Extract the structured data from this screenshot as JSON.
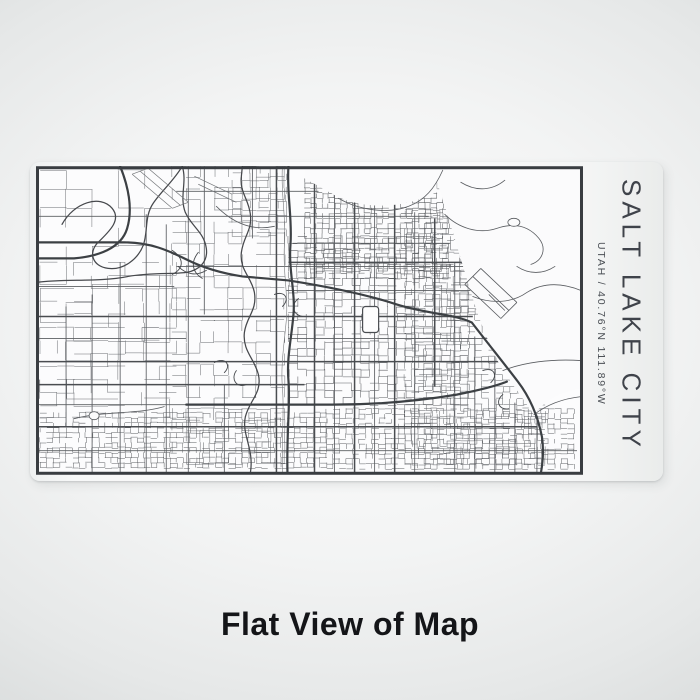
{
  "product": {
    "city_display": "SALT LAKE CITY",
    "coordinates": "UTAH / 40.76°N 111.89°W",
    "caption": "Flat View of Map"
  },
  "colors": {
    "ink": "#3f434a",
    "ink2": "#4b4f55",
    "caption_ink": "#141518",
    "backdrop_inner": "#fdfdfd",
    "backdrop_outer": "#c7caca",
    "wrap_fill": "#f8f9f9",
    "map_bg": "#fcfcfd",
    "frame_stroke": "#393d41"
  },
  "map": {
    "viewbox": [
      0,
      0,
      546,
      308
    ],
    "bg": "#fcfcfd",
    "cover_fill": "#fbfbfc",
    "frame": {
      "inset": 1.5,
      "width": 3,
      "stroke": "#393d41"
    },
    "districts": [
      {
        "x": 4,
        "y": 4,
        "w": 132,
        "h": 248,
        "cw": 26,
        "ch": 19,
        "skip": 0.55,
        "c": "#63666a",
        "wd": 0.5,
        "seed": 11
      },
      {
        "x": 4,
        "y": 96,
        "w": 140,
        "h": 150,
        "cw": 17,
        "ch": 13,
        "skip": 0.5,
        "c": "#63666a",
        "wd": 0.5,
        "seed": 12
      },
      {
        "x": 136,
        "y": 0,
        "w": 116,
        "h": 302,
        "cw": 14,
        "ch": 11,
        "skip": 0.45,
        "c": "#606367",
        "wd": 0.5,
        "seed": 22
      },
      {
        "x": 196,
        "y": 0,
        "w": 60,
        "h": 70,
        "cw": 9,
        "ch": 7,
        "skip": 0.4,
        "c": "#606367",
        "wd": 0.5,
        "seed": 23
      },
      {
        "x": 268,
        "y": 12,
        "w": 146,
        "h": 100,
        "cw": 6,
        "ch": 5,
        "skip": 0.24,
        "c": "#54575b",
        "wd": 0.55,
        "seed": 33
      },
      {
        "x": 252,
        "y": 70,
        "w": 180,
        "h": 172,
        "cw": 9,
        "ch": 7,
        "skip": 0.3,
        "c": "#56595d",
        "wd": 0.55,
        "seed": 44
      },
      {
        "x": 368,
        "y": 44,
        "w": 96,
        "h": 104,
        "cw": 7,
        "ch": 6,
        "skip": 0.34,
        "c": "#5a5d61",
        "wd": 0.5,
        "seed": 55
      },
      {
        "x": 368,
        "y": 142,
        "w": 140,
        "h": 158,
        "cw": 7,
        "ch": 6,
        "skip": 0.32,
        "c": "#5a5d61",
        "wd": 0.5,
        "seed": 56
      },
      {
        "x": 4,
        "y": 246,
        "w": 290,
        "h": 56,
        "cw": 6.5,
        "ch": 5,
        "skip": 0.3,
        "c": "#56595d",
        "wd": 0.5,
        "seed": 66
      },
      {
        "x": 290,
        "y": 242,
        "w": 248,
        "h": 62,
        "cw": 6.5,
        "ch": 5,
        "skip": 0.34,
        "c": "#56595d",
        "wd": 0.5,
        "seed": 77
      }
    ],
    "covers": [
      "M394,0 H544 V222 C520,226 506,236 497,248 L466,204 C454,182 444,158 436,132 C428,106 418,72 410,46 C405,30 400,14 394,0 Z",
      "M268,0 H400 V26 C368,42 330,44 300,30 L268,12 Z"
    ],
    "layers": {
      "majors": {
        "c": "#5b5e62",
        "w": 0.85,
        "d": [
          "M30,140 V260",
          "M56,128 V306",
          "M84,96 V306",
          "M110,48 V306",
          "M130,58 V306",
          "M152,0 V306",
          "M168,0 V148",
          "M188,218 V306",
          "M216,0 V72",
          "M298,14 V306",
          "M338,30 V306",
          "M378,46 V306",
          "M418,96 V306",
          "M438,170 V306",
          "M458,190 V306",
          "M478,236 V306",
          "M500,248 V306",
          "M140,25 H282",
          "M0,50 H392",
          "M256,77 H414",
          "M140,100 H430",
          "M250,124 H434",
          "M252,172 H452",
          "M0,238 H150",
          "M0,284 H540",
          "M0,120 H138",
          "M0,172 H150"
        ]
      },
      "darkMajors": {
        "c": "#4a4d51",
        "w": 1.5,
        "d": [
          "M240,0 V306",
          "M278,16 V306",
          "M318,24 V306",
          "M358,34 V306",
          "M398,52 V220",
          "M252,96 H430",
          "M0,150 H436",
          "M0,195 H464",
          "M0,218 H268",
          "M0,260 H500"
        ]
      },
      "diagonals": {
        "c": "#56595d",
        "w": 0.8,
        "d": [
          "M428,118 L464,152",
          "M436,110 L472,144",
          "M444,102 L480,136",
          "M428,118 L444,102",
          "M464,152 L480,136",
          "M452,128 L468,144"
        ]
      },
      "curvies": {
        "c": "#595c60",
        "w": 0.8,
        "d": [
          "M302,32 C322,44 352,48 372,40 C388,34 398,22 406,4",
          "M408,48 C422,62 442,68 460,62 C478,56 492,60 502,72 C510,82 506,94 494,98",
          "M436,130 C456,138 476,136 490,126 C506,116 524,116 544,124",
          "M466,204 C486,196 514,192 544,194",
          "M497,248 C510,238 526,232 544,230",
          "M424,16 C440,26 456,24 468,14",
          "M480,100 C492,108 506,108 518,100",
          "M38,252 C70,244 100,248 128,240",
          "M180,40 C200,60 220,64 238,60"
        ]
      },
      "ramps": {
        "c": "#46494d",
        "w": 0.9,
        "d": [
          "M136,84 C148,92 148,102 136,108",
          "M162,86 C154,96 156,106 166,112",
          "M238,128 C248,124 254,132 246,140",
          "M262,132 C254,138 256,148 266,150",
          "M178,196 C188,190 196,198 188,206",
          "M200,204 C194,212 200,222 210,218",
          "M446,204 C456,200 462,208 454,216",
          "M466,228 C458,234 462,244 472,242",
          "M142,100 C150,108 160,110 170,104"
        ]
      },
      "railroad": {
        "c": "#77797c",
        "w": 0.6,
        "d": [
          "M246,0 C244,26 250,52 248,78 C246,104 252,128 250,152 C248,176 244,198 246,222 C248,244 245,268 246,306"
        ]
      },
      "highways": {
        "c": "#3c4044",
        "w": 2.2,
        "d": [
          "M0,76 H88 C114,76 132,84 150,93 C168,102 186,107 206,110 L252,114",
          "M252,0 C250,26 256,52 254,78 C252,104 259,126 257,148 C255,172 250,192 252,214 C254,238 250,264 251,306",
          "M252,114 C290,120 330,128 360,138 C392,148 416,147 435,156",
          "M435,156 C452,178 468,198 481,215 C494,232 501,250 505,270 C507,284 506,295 504,306",
          "M84,0 C92,20 97,42 91,62 C85,82 62,90 38,92 L0,92",
          "M150,238 H296 C340,238 384,234 420,228 C440,224 458,220 470,215"
        ]
      },
      "water": {
        "c": "#46484c",
        "w": 1.25,
        "d": [
          "M26,58 C38,36 64,28 76,42 C86,54 72,66 62,76 C52,86 56,100 72,102 C88,104 102,92 107,79 C112,66 108,50 117,37 C125,25 138,14 146,0",
          "M146,0 C151,16 143,30 149,46 C155,60 168,66 170,82 C172,96 162,104 150,106",
          "M214,306 C218,282 205,268 209,250 C213,234 226,226 222,208 C218,192 206,184 208,166 C210,150 221,144 218,126 C215,110 203,104 205,86 C207,70 216,64 214,48 C212,32 203,26 205,10 L206,0",
          "M0,116 C30,112 62,116 92,110 C116,106 136,108 150,106"
        ]
      },
      "runways": {
        "c": "#737679",
        "w": 0.7,
        "d": [
          "M96,8 L136,42",
          "M104,5 L144,39",
          "M112,2 L152,36",
          "M96,8 L112,2",
          "M136,42 L152,36",
          "M158,10 L196,28",
          "M162,18 L200,36"
        ]
      }
    },
    "shapes": [
      {
        "type": "rect",
        "x": 326,
        "y": 140,
        "w": 16,
        "h": 26,
        "rx": 3,
        "stroke": "#4a4d51",
        "sw": 1.2,
        "fill": "#fdfdfd"
      },
      {
        "type": "ellipse",
        "cx": 477,
        "cy": 56,
        "rx": 6,
        "ry": 4,
        "stroke": "#595c60",
        "sw": 0.8,
        "fill": "#fbfbfc"
      },
      {
        "type": "ellipse",
        "cx": 58,
        "cy": 249,
        "rx": 5,
        "ry": 4,
        "stroke": "#595c60",
        "sw": 0.8,
        "fill": "#fbfbfc"
      }
    ]
  }
}
